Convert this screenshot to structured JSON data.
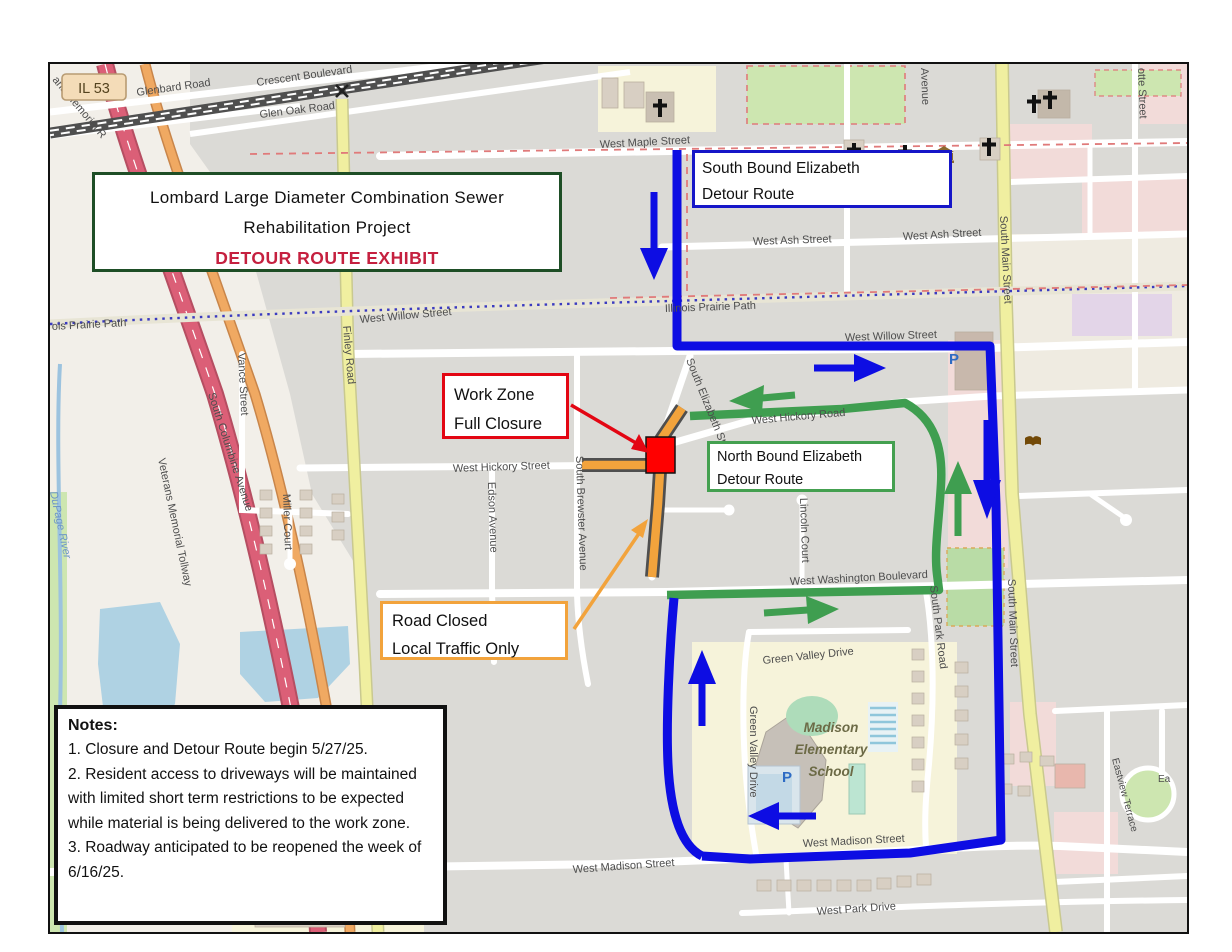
{
  "title_box": {
    "line1": "Lombard  Large Diameter Combination Sewer",
    "line2": "Rehabilitation Project",
    "line3": "DETOUR ROUTE EXHIBIT"
  },
  "callouts": {
    "south_bound": {
      "line1": "South Bound Elizabeth",
      "line2": "Detour Route"
    },
    "north_bound": {
      "line1": "North Bound Elizabeth",
      "line2": "Detour Route"
    },
    "work_zone": {
      "line1": "Work Zone",
      "line2": "Full Closure"
    },
    "road_closed": {
      "line1": "Road Closed",
      "line2": "Local Traffic Only"
    }
  },
  "notes": {
    "heading": "Notes:",
    "items": [
      "1.  Closure and Detour Route begin 5/27/25.",
      "2. Resident access to driveways will be maintained with limited short term restrictions to be expected while material is being delivered to the work zone.",
      "3.  Roadway anticipated to be reopened the week of 6/16/25."
    ]
  },
  "streets": [
    "Glenbard Road",
    "Crescent Boulevard",
    "Glen Oak Road",
    "West Maple Street",
    "West Ash Street",
    "West Ash Street",
    "Illinois Prairie Path",
    "ois Prairie Path",
    "West Willow Street",
    "West Willow Street",
    "West Hickory Street",
    "West Hickory Road",
    "West Washington Boulevard",
    "Green Valley Drive",
    "Green Valley Drive",
    "West Madison Street",
    "West Madison Street",
    "West Park Drive",
    "Finley Road",
    "South Main Street",
    "South Main Street",
    "South Elizabeth Street",
    "South Brewster Avenue",
    "Edson Avenue",
    "Vance Street",
    "Miller Court",
    "Lincoln Court",
    "South Park Road",
    "South Columbine Avenue",
    "Veterans Memorial Tollway",
    "DuPage River",
    "Eastview Terrace",
    "otte Street",
    "Avenue",
    "ans Memorial R",
    "Ea"
  ],
  "pois": {
    "highway_shield": "IL 53",
    "school_line1": "Madison",
    "school_line2": "Elementary",
    "school_line3": "School",
    "parking": "P"
  },
  "colors": {
    "southbound_route_blue": "#0D0DE3",
    "northbound_route_green": "#3F9E50",
    "road_closed_orange": "#F2A33C",
    "work_zone_red": "#FF0000",
    "exhibit_title_red": "#C5203F",
    "title_border_green": "#1E4E26"
  }
}
